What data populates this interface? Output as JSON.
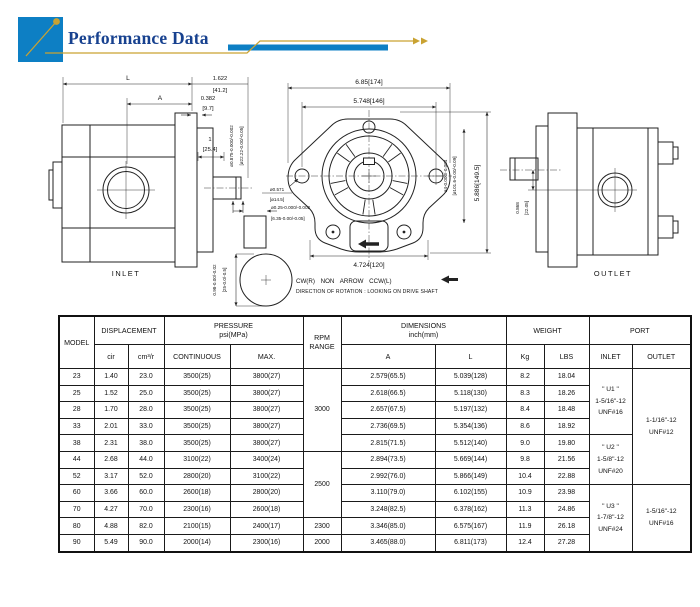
{
  "header": {
    "title": "Performance Data"
  },
  "colors": {
    "brand_blue": "#0d7fc4",
    "navy": "#17418f",
    "gold": "#c9a232"
  },
  "drawing": {
    "inlet_label": "INLET",
    "outlet_label": "OUTLET",
    "rotation_line1": "CW(R) NON ARROW CCW(L)",
    "rotation_line2": "DIRECTION OF ROTATION : LOOKING ON DRIVE SHAFT",
    "dim_L": "L",
    "dim_A": "A",
    "dim_1622": "1.622",
    "dim_1622_mm": "[41.2]",
    "dim_0382": "0.382",
    "dim_0382_mm": "[9.7]",
    "dim_1": "1",
    "dim_1_mm": "[25.4]",
    "dim_shaft_in": "ø0.875-0.000/-0.002",
    "dim_shaft_mm": "[ø22.22-0.00/-0.05]",
    "dim_key_len_in": "0.98-0.00/-0.02",
    "dim_key_len_mm": "[25-0.0/-0.5]",
    "dim_key_w_in": "ø0.25-0.000/-0.002",
    "dim_key_w_mm": "[6.35-0.00/-0.05]",
    "dim_685": "6.85[174]",
    "dim_5748": "5.748[146]",
    "dim_5886": "5.886[149.5]",
    "dim_4724": "4.724[120]",
    "dim_pilot_in": "ø4-0.000/-0.004",
    "dim_pilot_mm": "[ø101.6-0.00/-0.09]",
    "dim_0571": "ø0.571",
    "dim_0571_mm": "[ø14.5]",
    "dim_0868": "0.868",
    "dim_0868_mm": "[22.05]"
  },
  "table": {
    "headers": {
      "model": "MODEL",
      "displacement": "DISPLACEMENT",
      "pressure": "PRESSURE\npsi(MPa)",
      "rpm": "RPM\nRANGE",
      "dimensions": "DIMENSIONS\ninch(mm)",
      "weight": "WEIGHT",
      "port": "PORT",
      "cir": "cir",
      "cm3r": "cm³/r",
      "continuous": "CONTINUOUS",
      "max": "MAX.",
      "a": "A",
      "l": "L",
      "kg": "Kg",
      "lbs": "LBS",
      "inlet": "INLET",
      "outlet": "OUTLET"
    },
    "rows": [
      {
        "model": "23",
        "cir": "1.40",
        "cm3r": "23.0",
        "continuous": "3500(25)",
        "max": "3800(27)",
        "a": "2.579(65.5)",
        "l": "5.039(128)",
        "kg": "8.2",
        "lbs": "18.04"
      },
      {
        "model": "25",
        "cir": "1.52",
        "cm3r": "25.0",
        "continuous": "3500(25)",
        "max": "3800(27)",
        "a": "2.618(66.5)",
        "l": "5.118(130)",
        "kg": "8.3",
        "lbs": "18.26"
      },
      {
        "model": "28",
        "cir": "1.70",
        "cm3r": "28.0",
        "continuous": "3500(25)",
        "max": "3800(27)",
        "a": "2.657(67.5)",
        "l": "5.197(132)",
        "kg": "8.4",
        "lbs": "18.48"
      },
      {
        "model": "33",
        "cir": "2.01",
        "cm3r": "33.0",
        "continuous": "3500(25)",
        "max": "3800(27)",
        "a": "2.736(69.5)",
        "l": "5.354(136)",
        "kg": "8.6",
        "lbs": "18.92"
      },
      {
        "model": "38",
        "cir": "2.31",
        "cm3r": "38.0",
        "continuous": "3500(25)",
        "max": "3800(27)",
        "a": "2.815(71.5)",
        "l": "5.512(140)",
        "kg": "9.0",
        "lbs": "19.80"
      },
      {
        "model": "44",
        "cir": "2.68",
        "cm3r": "44.0",
        "continuous": "3100(22)",
        "max": "3400(24)",
        "a": "2.894(73.5)",
        "l": "5.669(144)",
        "kg": "9.8",
        "lbs": "21.56"
      },
      {
        "model": "52",
        "cir": "3.17",
        "cm3r": "52.0",
        "continuous": "2800(20)",
        "max": "3100(22)",
        "a": "2.992(76.0)",
        "l": "5.866(149)",
        "kg": "10.4",
        "lbs": "22.88"
      },
      {
        "model": "60",
        "cir": "3.66",
        "cm3r": "60.0",
        "continuous": "2600(18)",
        "max": "2800(20)",
        "a": "3.110(79.0)",
        "l": "6.102(155)",
        "kg": "10.9",
        "lbs": "23.98"
      },
      {
        "model": "70",
        "cir": "4.27",
        "cm3r": "70.0",
        "continuous": "2300(16)",
        "max": "2600(18)",
        "a": "3.248(82.5)",
        "l": "6.378(162)",
        "kg": "11.3",
        "lbs": "24.86"
      },
      {
        "model": "80",
        "cir": "4.88",
        "cm3r": "82.0",
        "continuous": "2100(15)",
        "max": "2400(17)",
        "a": "3.346(85.0)",
        "l": "6.575(167)",
        "kg": "11.9",
        "lbs": "26.18"
      },
      {
        "model": "90",
        "cir": "5.49",
        "cm3r": "90.0",
        "continuous": "2000(14)",
        "max": "2300(16)",
        "a": "3.465(88.0)",
        "l": "6.811(173)",
        "kg": "12.4",
        "lbs": "27.28"
      }
    ],
    "rpm_groups": [
      {
        "value": "3000",
        "span": 5
      },
      {
        "value": "2500",
        "span": 4
      },
      {
        "value": "2300",
        "span": 1
      },
      {
        "value": "2000",
        "span": 1
      }
    ],
    "inlet_groups": [
      {
        "value": "\" U1 \"\n1-5/16\"-12\nUNF#16",
        "span": 4
      },
      {
        "value": "\" U2 \"\n1-5/8\"-12\nUNF#20",
        "span": 3
      },
      {
        "value": "\" U3 \"\n1-7/8\"-12\nUNF#24",
        "span": 4
      }
    ],
    "outlet_groups": [
      {
        "value": "1-1/16\"-12\nUNF#12",
        "span": 7
      },
      {
        "value": "1-5/16\"-12\nUNF#16",
        "span": 4
      }
    ]
  }
}
